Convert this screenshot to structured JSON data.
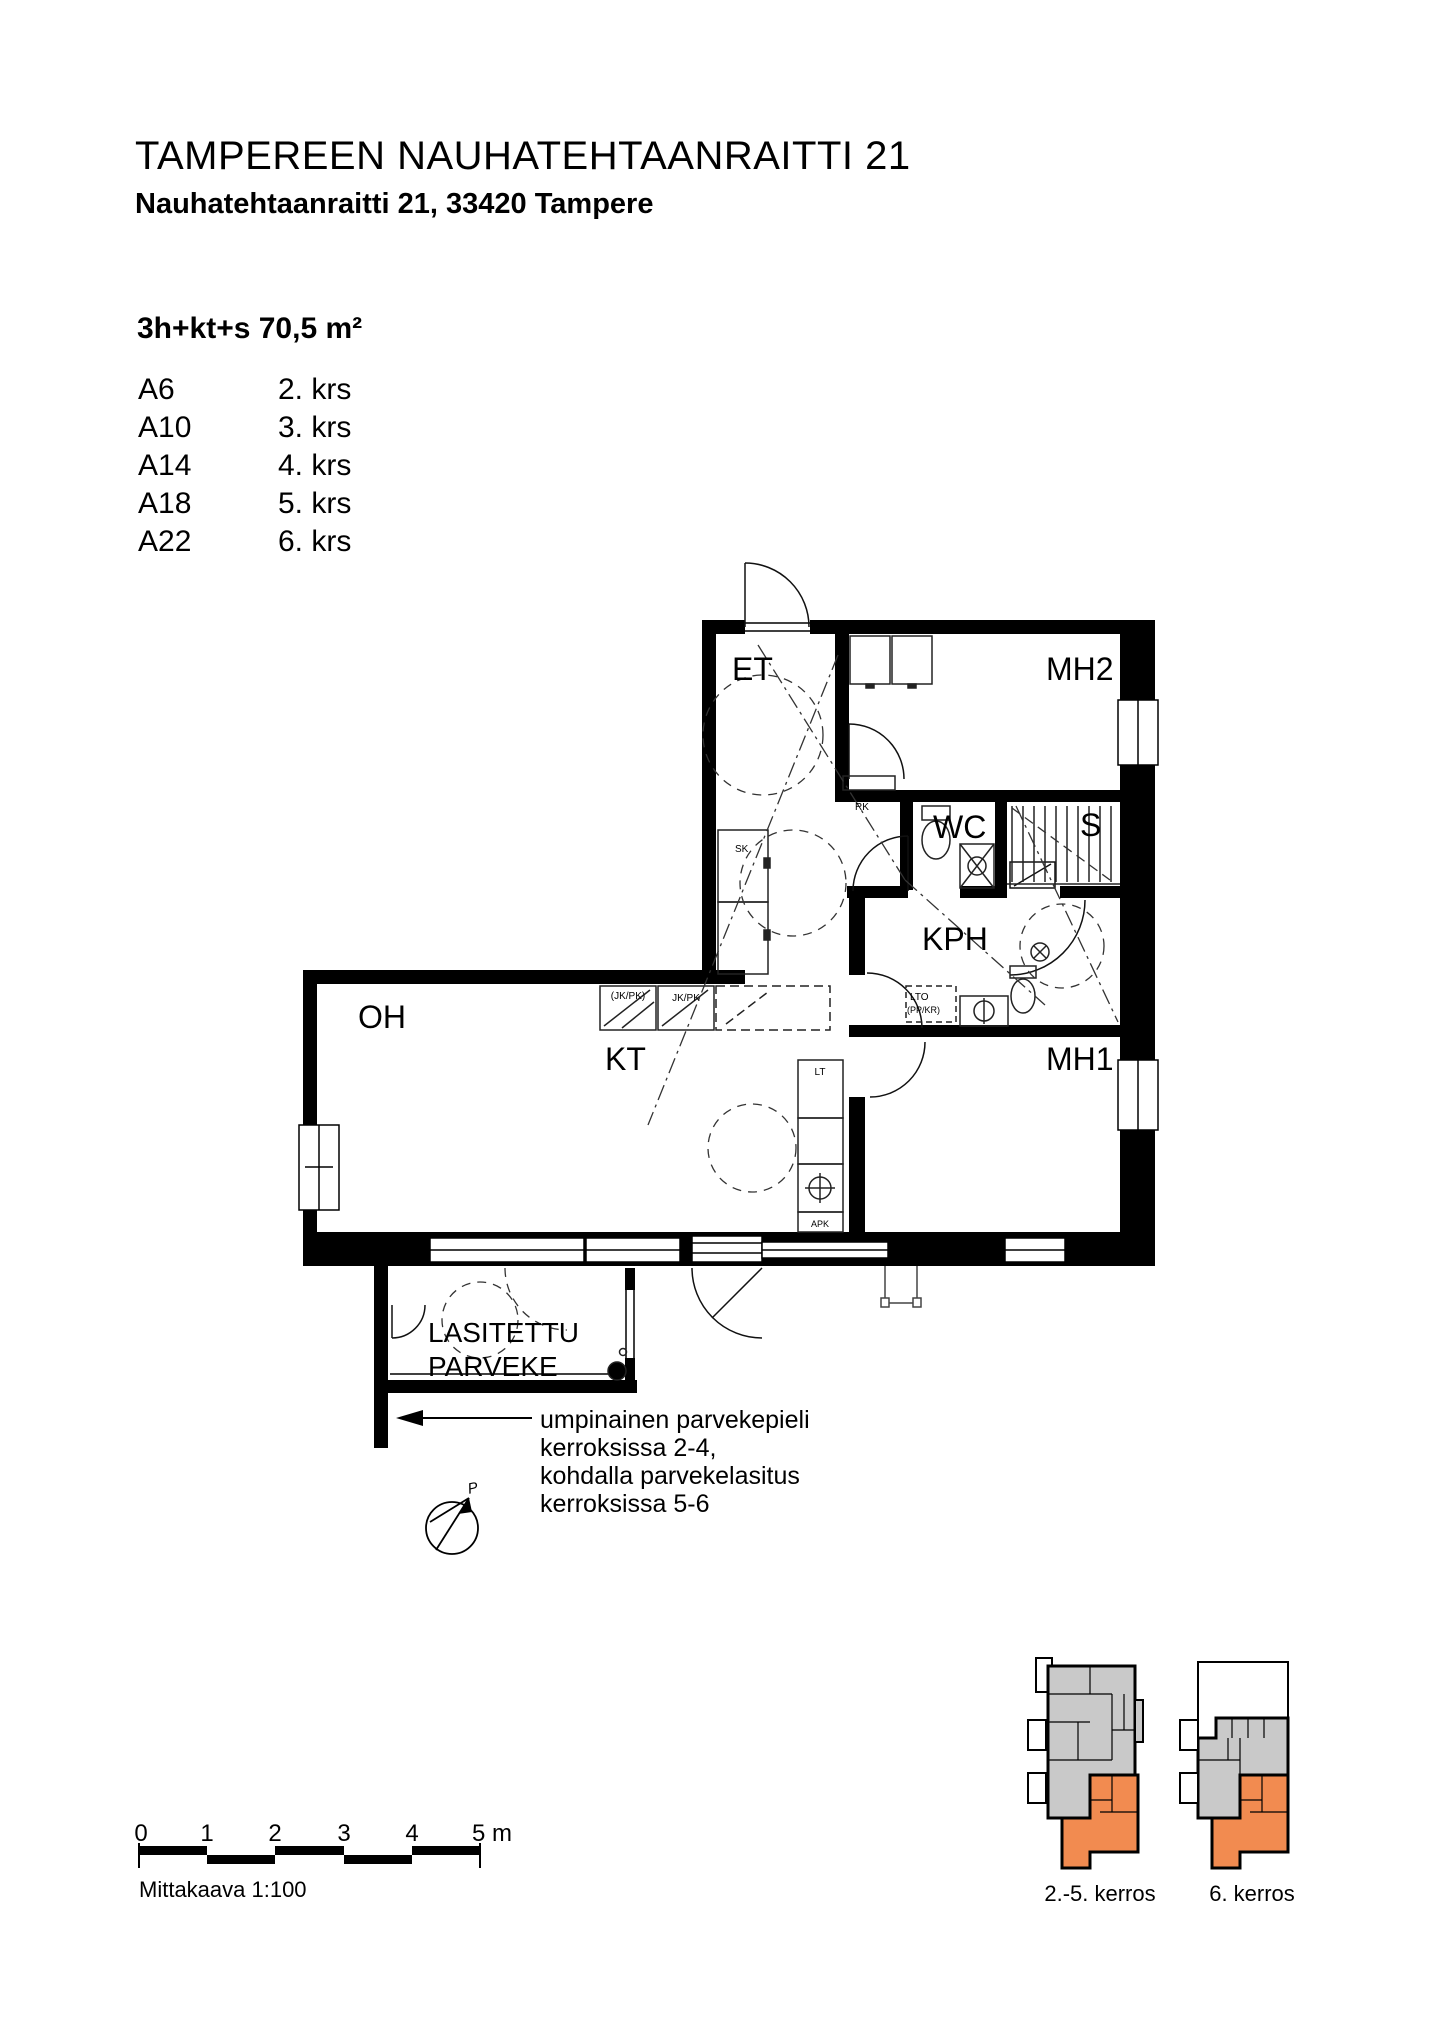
{
  "document": {
    "title": "TAMPEREEN NAUHATEHTAANRAITTI 21",
    "address": "Nauhatehtaanraitti 21, 33420 Tampere",
    "apartment_type": "3h+kt+s 70,5 m²",
    "units": [
      {
        "unit": "A6",
        "floor": "2. krs"
      },
      {
        "unit": "A10",
        "floor": "3. krs"
      },
      {
        "unit": "A14",
        "floor": "4. krs"
      },
      {
        "unit": "A18",
        "floor": "5. krs"
      },
      {
        "unit": "A22",
        "floor": "6. krs"
      }
    ]
  },
  "floor_plan": {
    "rooms": {
      "entry": "ET",
      "bedroom2": "MH2",
      "wc": "WC",
      "sauna": "S",
      "bathroom": "KPH",
      "living": "OH",
      "kitchen": "KT",
      "bedroom1": "MH1"
    },
    "balcony": {
      "line1": "LASITETTU",
      "line2": "PARVEKE"
    },
    "fixtures": {
      "rk": "RK",
      "sk": "SK",
      "jkpk_optional": "(JK/PK)",
      "jkpk": "JK/PK",
      "lt": "LT",
      "apk": "APK",
      "lto": "LTO",
      "lto_sub": "(PP/KR)"
    },
    "north_label": "P",
    "annotation": [
      "umpinainen parvekepieli",
      "kerroksissa 2-4,",
      "kohdalla parvekelasitus",
      "kerroksissa 5-6"
    ]
  },
  "scale_bar": {
    "ticks": [
      "0",
      "1",
      "2",
      "3",
      "4",
      "5 m"
    ],
    "caption": "Mittakaava 1:100"
  },
  "key_plans": {
    "left_label": "2.-5. kerros",
    "right_label": "6. kerros",
    "highlight_color": "#F28B50",
    "building_color": "#C9C9C9"
  }
}
